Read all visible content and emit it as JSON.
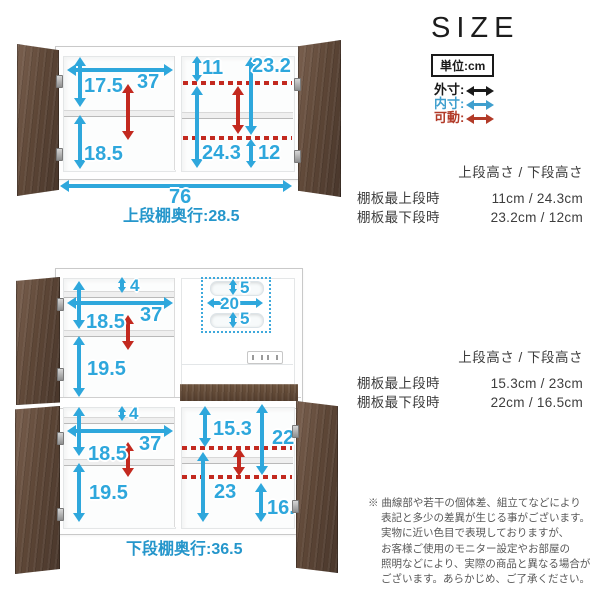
{
  "colors": {
    "arrow_outer": "#1a1a1a",
    "arrow_inner": "#2ea7dc",
    "arrow_movable": "#c3291f",
    "wood": "#5e4737",
    "label_blue": "#2596cb"
  },
  "legend": {
    "title": "SIZE",
    "unit": "単位:cm",
    "items": [
      {
        "label": "外寸:",
        "name": "outer"
      },
      {
        "label": "内寸:",
        "name": "inner"
      },
      {
        "label": "可動:",
        "name": "movable"
      }
    ]
  },
  "upper_unit": {
    "left_top_height": "17.5",
    "shelf_width": "37",
    "left_bottom_height": "18.5",
    "right_top_gap": "11",
    "right_top_max": "23.2",
    "right_bottom_max": "24.3",
    "right_bottom_gap": "12",
    "total_width": "76",
    "depth_label": "上段棚奥行:28.5"
  },
  "upper_spec": {
    "header": "上段高さ / 下段高さ",
    "rows": [
      {
        "label": "棚板最上段時",
        "value": "11cm / 24.3cm"
      },
      {
        "label": "棚板最下段時",
        "value": "23.2cm / 12cm"
      }
    ]
  },
  "lower_unit": {
    "upper_left": {
      "top_gap": "4",
      "width": "37",
      "upper_height": "18.5",
      "lower_height": "19.5"
    },
    "niche": {
      "top_slot": "5",
      "slot_width": "20",
      "bottom_slot": "5"
    },
    "lower_left": {
      "top_gap": "4",
      "width": "37",
      "upper_height": "18.5",
      "lower_height": "19.5"
    },
    "lower_right": {
      "upper_min": "15.3",
      "upper_max": "22",
      "lower_max": "23",
      "lower_min": "16.5"
    },
    "depth_label": "下段棚奥行:36.5"
  },
  "lower_spec": {
    "header": "上段高さ / 下段高さ",
    "rows": [
      {
        "label": "棚板最上段時",
        "value": "15.3cm / 23cm"
      },
      {
        "label": "棚板最下段時",
        "value": "22cm / 16.5cm"
      }
    ]
  },
  "disclaimer": {
    "lines": [
      "※ 曲線部や若干の個体差、組立てなどにより",
      "表記と多少の差異が生じる事がございます。",
      "実物に近い色目で表現しておりますが、",
      "お客様ご使用のモニター設定やお部屋の",
      "照明などにより、実際の商品と異なる場合が",
      "ございます。あらかじめ、ご了承ください。"
    ]
  }
}
